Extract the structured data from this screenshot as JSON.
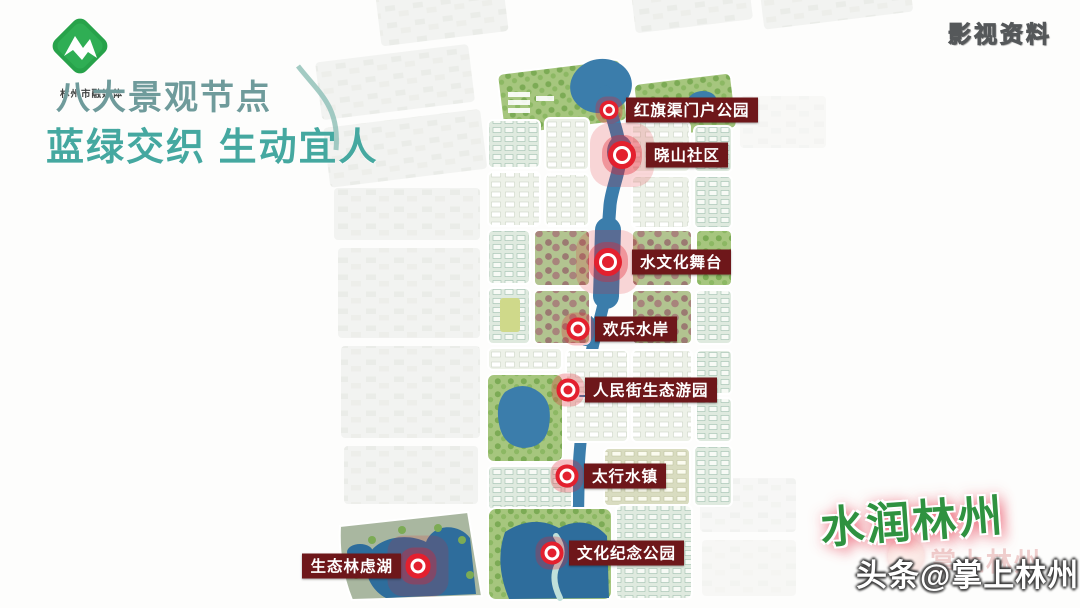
{
  "header": {
    "logo_caption": "林州市融媒体",
    "title": "八大景观节点",
    "subtitle": "蓝绿交织 生动宜人"
  },
  "watermarks": {
    "top_right": "影视资料",
    "calligraphy": "水润林州",
    "ghost_credit": "掌上林州",
    "credit": "头条@掌上林州"
  },
  "map": {
    "description": "urban-waterfront-planning-map",
    "markers": [
      {
        "label": "红旗渠门户公园",
        "x": 609,
        "y": 110,
        "size": "small",
        "label_side": "right"
      },
      {
        "label": "晓山社区",
        "x": 622,
        "y": 155,
        "size": "large",
        "label_side": "right"
      },
      {
        "label": "水文化舞台",
        "x": 608,
        "y": 262,
        "size": "large",
        "label_side": "right"
      },
      {
        "label": "欢乐水岸",
        "x": 578,
        "y": 329,
        "size": "medium",
        "label_side": "right"
      },
      {
        "label": "人民街生态游园",
        "x": 568,
        "y": 390,
        "size": "medium",
        "label_side": "right"
      },
      {
        "label": "太行水镇",
        "x": 567,
        "y": 476,
        "size": "medium",
        "label_side": "right"
      },
      {
        "label": "文化纪念公园",
        "x": 552,
        "y": 553,
        "size": "medium",
        "label_side": "right"
      },
      {
        "label": "生态林虑湖",
        "x": 418,
        "y": 566,
        "size": "medium",
        "label_side": "left"
      }
    ],
    "colors": {
      "marker_red": "#e3202e",
      "label_bg": "#6e171a",
      "label_text": "#ffffff",
      "lake_blue": "#3b7dab",
      "deep_lake_blue": "#2e6d9c",
      "park_green": "#a6c67e",
      "sage_land": "#a9b7a0",
      "maroon_blocks": "#9b7a72",
      "title_teal": "#6f9b9b",
      "subtitle_teal": "#45a8a0",
      "logo_green": "#27a24a"
    }
  }
}
